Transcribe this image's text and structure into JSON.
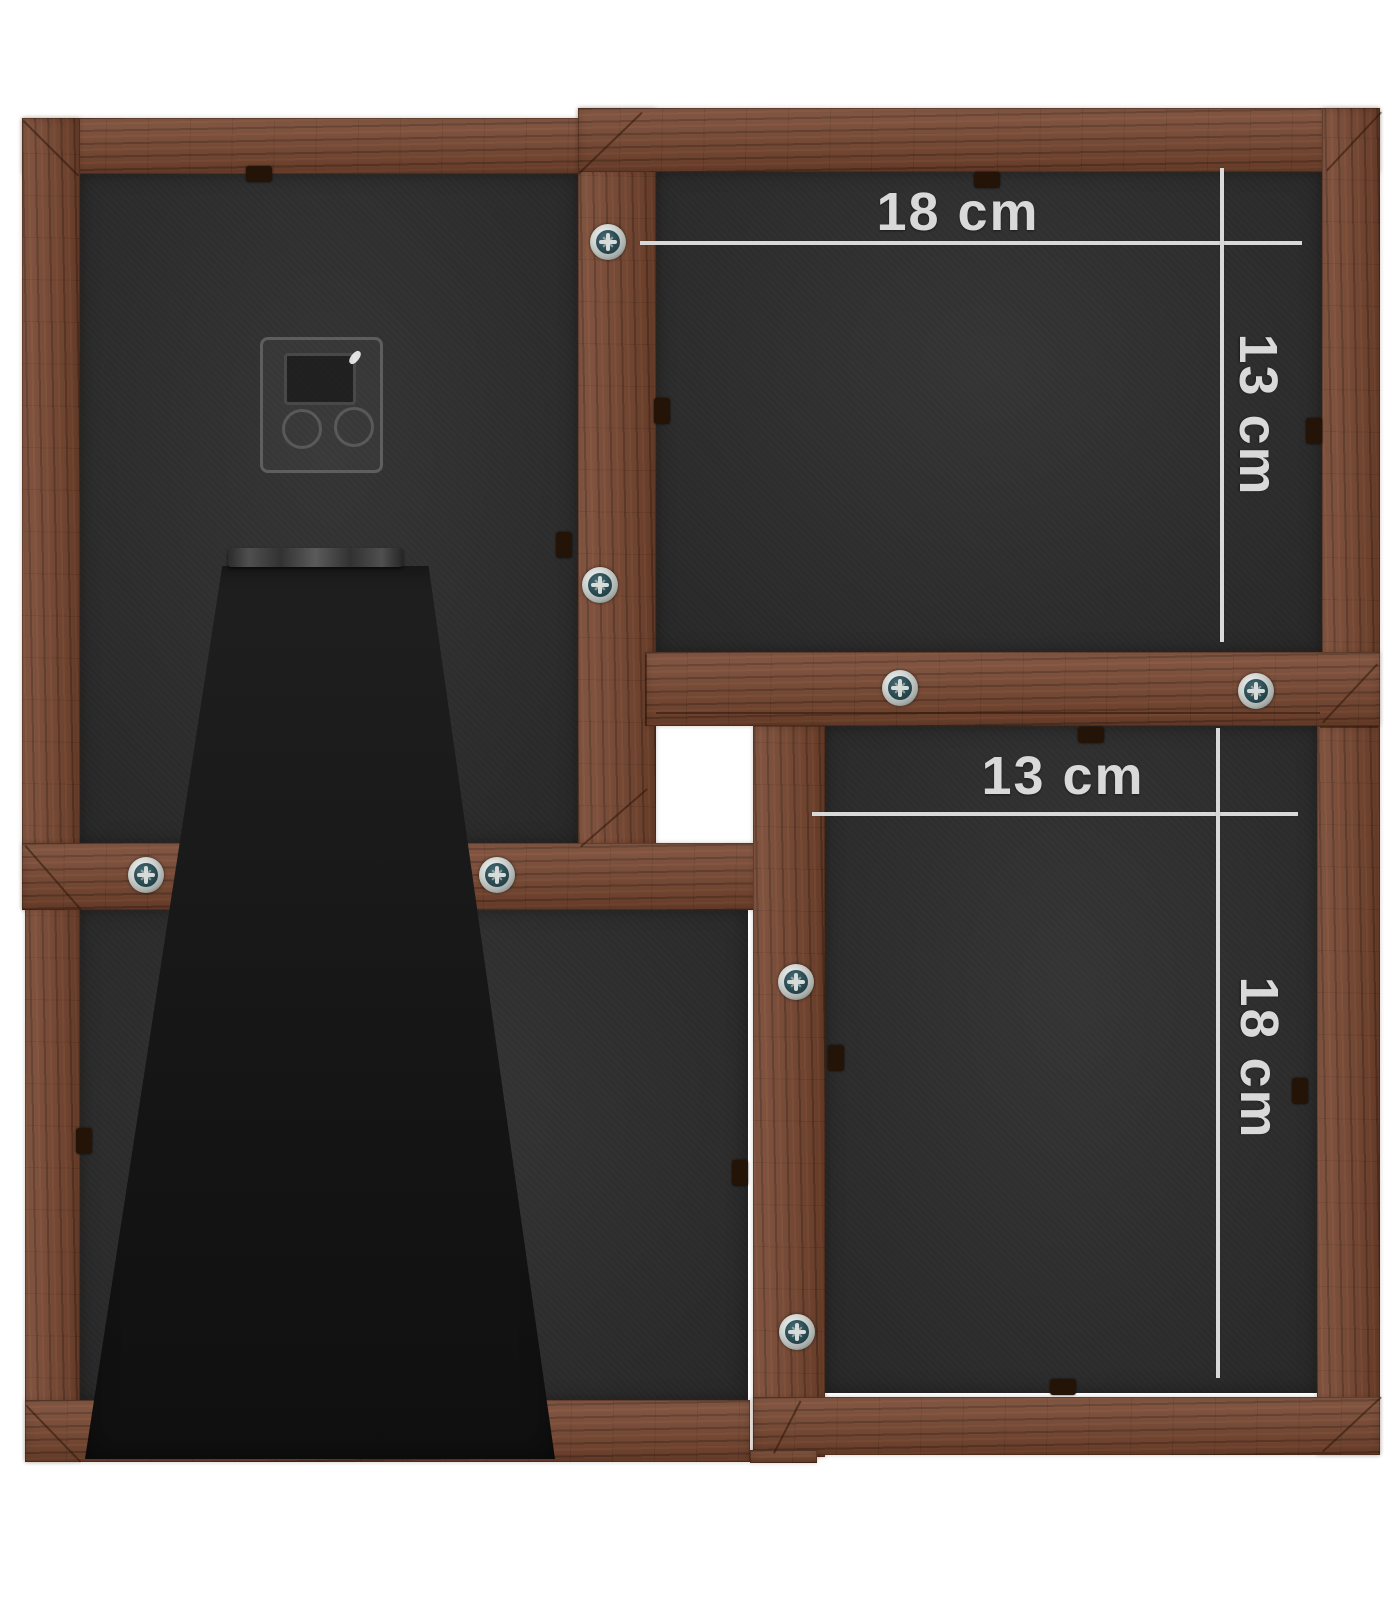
{
  "product": {
    "description": "Back view of a 4-photo wooden collage frame with stand",
    "background_color": "#ffffff",
    "wood_color": "#774630",
    "backing_color": "#2d2d2d",
    "kickstand_color": "#161616",
    "dimension_color": "#d9d9d9",
    "screw_outer_color": "#c9cdcb",
    "screw_inner_color": "#2a4a52",
    "clip_color": "#241307"
  },
  "dimensions": {
    "top_right_frame": {
      "width_label": "18 cm",
      "height_label": "13 cm"
    },
    "bottom_right_frame": {
      "width_label": "13 cm",
      "height_label": "18 cm"
    }
  },
  "scene": {
    "backings": [
      {
        "name": "top-left-frame-backing",
        "x": 78,
        "y": 172,
        "w": 502,
        "h": 673
      },
      {
        "name": "top-right-frame-backing",
        "x": 654,
        "y": 170,
        "w": 668,
        "h": 484
      },
      {
        "name": "bottom-right-frame-backing",
        "x": 823,
        "y": 726,
        "w": 496,
        "h": 667
      },
      {
        "name": "bottom-left-frame-backing",
        "x": 78,
        "y": 908,
        "w": 670,
        "h": 494
      }
    ],
    "wood": [
      {
        "name": "top-left-frame-top-bar",
        "x": 22,
        "y": 118,
        "w": 618,
        "h": 56,
        "grain": "h"
      },
      {
        "name": "top-left-frame-left-bar",
        "x": 22,
        "y": 118,
        "w": 58,
        "h": 792,
        "grain": "v"
      },
      {
        "name": "center-vertical-bar",
        "x": 578,
        "y": 108,
        "w": 78,
        "h": 740,
        "grain": "v"
      },
      {
        "name": "top-right-frame-top-bar",
        "x": 578,
        "y": 108,
        "w": 802,
        "h": 64,
        "grain": "h"
      },
      {
        "name": "top-right-frame-right-bar",
        "x": 1322,
        "y": 108,
        "w": 58,
        "h": 618,
        "grain": "v"
      },
      {
        "name": "middle-right-horizontal-bar",
        "x": 645,
        "y": 652,
        "w": 735,
        "h": 74,
        "grain": "h"
      },
      {
        "name": "bottom-left-frame-left-bar",
        "x": 25,
        "y": 843,
        "w": 55,
        "h": 619,
        "grain": "v"
      },
      {
        "name": "middle-left-horizontal-bar",
        "x": 22,
        "y": 843,
        "w": 800,
        "h": 67,
        "grain": "h"
      },
      {
        "name": "bottom-right-frame-left-bar",
        "x": 753,
        "y": 726,
        "w": 72,
        "h": 731,
        "grain": "v"
      },
      {
        "name": "bottom-right-frame-right-bar",
        "x": 1317,
        "y": 726,
        "w": 63,
        "h": 729,
        "grain": "v"
      },
      {
        "name": "bottom-right-frame-bottom-bar",
        "x": 753,
        "y": 1397,
        "w": 627,
        "h": 58,
        "grain": "h"
      },
      {
        "name": "bottom-left-frame-bottom-bar",
        "x": 25,
        "y": 1400,
        "w": 725,
        "h": 62,
        "grain": "h"
      },
      {
        "name": "bottom-bar-sliver",
        "x": 750,
        "y": 1450,
        "w": 67,
        "h": 13,
        "grain": "h"
      }
    ],
    "seams": [
      {
        "name": "miter-top-left-corner",
        "x": 24,
        "y": 120,
        "len": 78,
        "deg": 45
      },
      {
        "name": "miter-center-bar-top",
        "x": 578,
        "y": 173,
        "len": 88,
        "deg": -44
      },
      {
        "name": "miter-top-right-corner",
        "x": 1326,
        "y": 170,
        "len": 80,
        "deg": -47
      },
      {
        "name": "miter-center-bar-bottom",
        "x": 580,
        "y": 846,
        "len": 88,
        "deg": -41
      },
      {
        "name": "seam-middle-bar-left",
        "x": 647,
        "y": 654,
        "len": 72,
        "deg": 90
      },
      {
        "name": "seam-middle-bars",
        "x": 656,
        "y": 712,
        "len": 664,
        "deg": 0
      },
      {
        "name": "seam-right-column",
        "x": 1320,
        "y": 726,
        "len": 58,
        "deg": 0
      },
      {
        "name": "miter-bottomright-frame-topright",
        "x": 1322,
        "y": 722,
        "len": 80,
        "deg": -47
      },
      {
        "name": "miter-left-band",
        "x": 26,
        "y": 845,
        "len": 85,
        "deg": 49
      },
      {
        "name": "miter-bottom-left-corner",
        "x": 27,
        "y": 1405,
        "len": 78,
        "deg": 46
      },
      {
        "name": "miter-bottomright-frame-bottomleft",
        "x": 773,
        "y": 1453,
        "len": 59,
        "deg": -63
      },
      {
        "name": "miter-bottom-right-corner",
        "x": 1322,
        "y": 1451,
        "len": 80,
        "deg": -43
      }
    ],
    "screws": [
      {
        "name": "screw",
        "x": 608,
        "y": 242
      },
      {
        "name": "screw",
        "x": 600,
        "y": 585
      },
      {
        "name": "screw",
        "x": 900,
        "y": 688
      },
      {
        "name": "screw",
        "x": 1256,
        "y": 691
      },
      {
        "name": "screw",
        "x": 146,
        "y": 875
      },
      {
        "name": "screw",
        "x": 497,
        "y": 875
      },
      {
        "name": "screw",
        "x": 796,
        "y": 982
      },
      {
        "name": "screw",
        "x": 797,
        "y": 1332
      }
    ],
    "clips": [
      {
        "name": "retaining-clip",
        "x": 246,
        "y": 166,
        "w": 26,
        "h": 16
      },
      {
        "name": "retaining-clip",
        "x": 556,
        "y": 532,
        "w": 16,
        "h": 26
      },
      {
        "name": "retaining-clip",
        "x": 974,
        "y": 172,
        "w": 26,
        "h": 16
      },
      {
        "name": "retaining-clip",
        "x": 654,
        "y": 398,
        "w": 16,
        "h": 26
      },
      {
        "name": "retaining-clip",
        "x": 1306,
        "y": 418,
        "w": 16,
        "h": 26
      },
      {
        "name": "retaining-clip",
        "x": 1078,
        "y": 727,
        "w": 26,
        "h": 16
      },
      {
        "name": "retaining-clip",
        "x": 1292,
        "y": 1078,
        "w": 16,
        "h": 26
      },
      {
        "name": "retaining-clip",
        "x": 1050,
        "y": 1379,
        "w": 26,
        "h": 16
      },
      {
        "name": "retaining-clip",
        "x": 828,
        "y": 1045,
        "w": 16,
        "h": 26
      },
      {
        "name": "retaining-clip",
        "x": 732,
        "y": 1160,
        "w": 16,
        "h": 26
      },
      {
        "name": "retaining-clip",
        "x": 76,
        "y": 1128,
        "w": 16,
        "h": 26
      }
    ]
  }
}
